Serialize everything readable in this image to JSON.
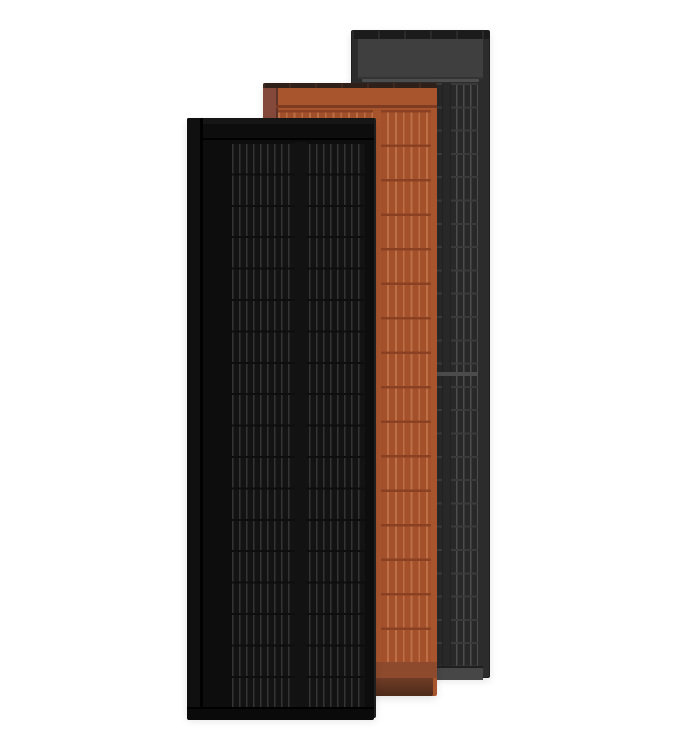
{
  "scene": {
    "description": "Product render of three overlapping portrait-orientation roof solar panels on a white background",
    "background": "#ffffff",
    "panels": [
      {
        "id": "charcoal",
        "label": "charcoal gray solar panel",
        "position": "back right",
        "features": [
          "dark top mounting strip",
          "plain gray header section",
          "two columns of solar cells with vertical busbars",
          "light mid-height divider",
          "light gray bottom strip"
        ]
      },
      {
        "id": "terracotta",
        "label": "terracotta solar panel",
        "position": "middle",
        "features": [
          "dark top edge",
          "shadowed left flap",
          "terracotta header with groove",
          "two columns of terracotta-tinted solar cells",
          "muted bottom band",
          "dark brown bottom edge"
        ]
      },
      {
        "id": "black",
        "label": "all-black solar panel",
        "position": "front left",
        "features": [
          "black frame with left flap groove",
          "black header with groove line",
          "two columns of black solar cells with faint busbars",
          "black bottom strip"
        ]
      }
    ]
  },
  "colors": {
    "bg": "#ffffff",
    "gry-frame": "#2c2c2c",
    "gry-topstrip": "#1b1b1b",
    "gry-header": "#3f3f3f",
    "gry-sep": "#585858",
    "gry-cell-bg": "#282828",
    "gry-busbar": "#4d4d4d",
    "gry-rowline": "#3a3a3a",
    "gry-mid": "#4c4c4c",
    "gry-bottom": "#474747",
    "ter-body": "#a8552e",
    "ter-topstrip": "#30201a",
    "ter-flap": "#7b4433",
    "ter-groove": "#7d3c21",
    "ter-cell-bg": "#a4512b",
    "ter-busbar": "#bd6f45",
    "ter-rowline": "#8a4123",
    "ter-band": "#8d4a2c",
    "ter-bottom-1": "#6f3c26",
    "ter-bottom-2": "#4e2b1a",
    "blk-frame": "#0d0d0d",
    "blk-frame-top": "#161616",
    "blk-groove": "#010101",
    "blk-cell-bg": "#131313",
    "blk-busbar": "#343434",
    "blk-rowline": "#0e0e0e",
    "blk-bottom": "#0a0a0a"
  }
}
